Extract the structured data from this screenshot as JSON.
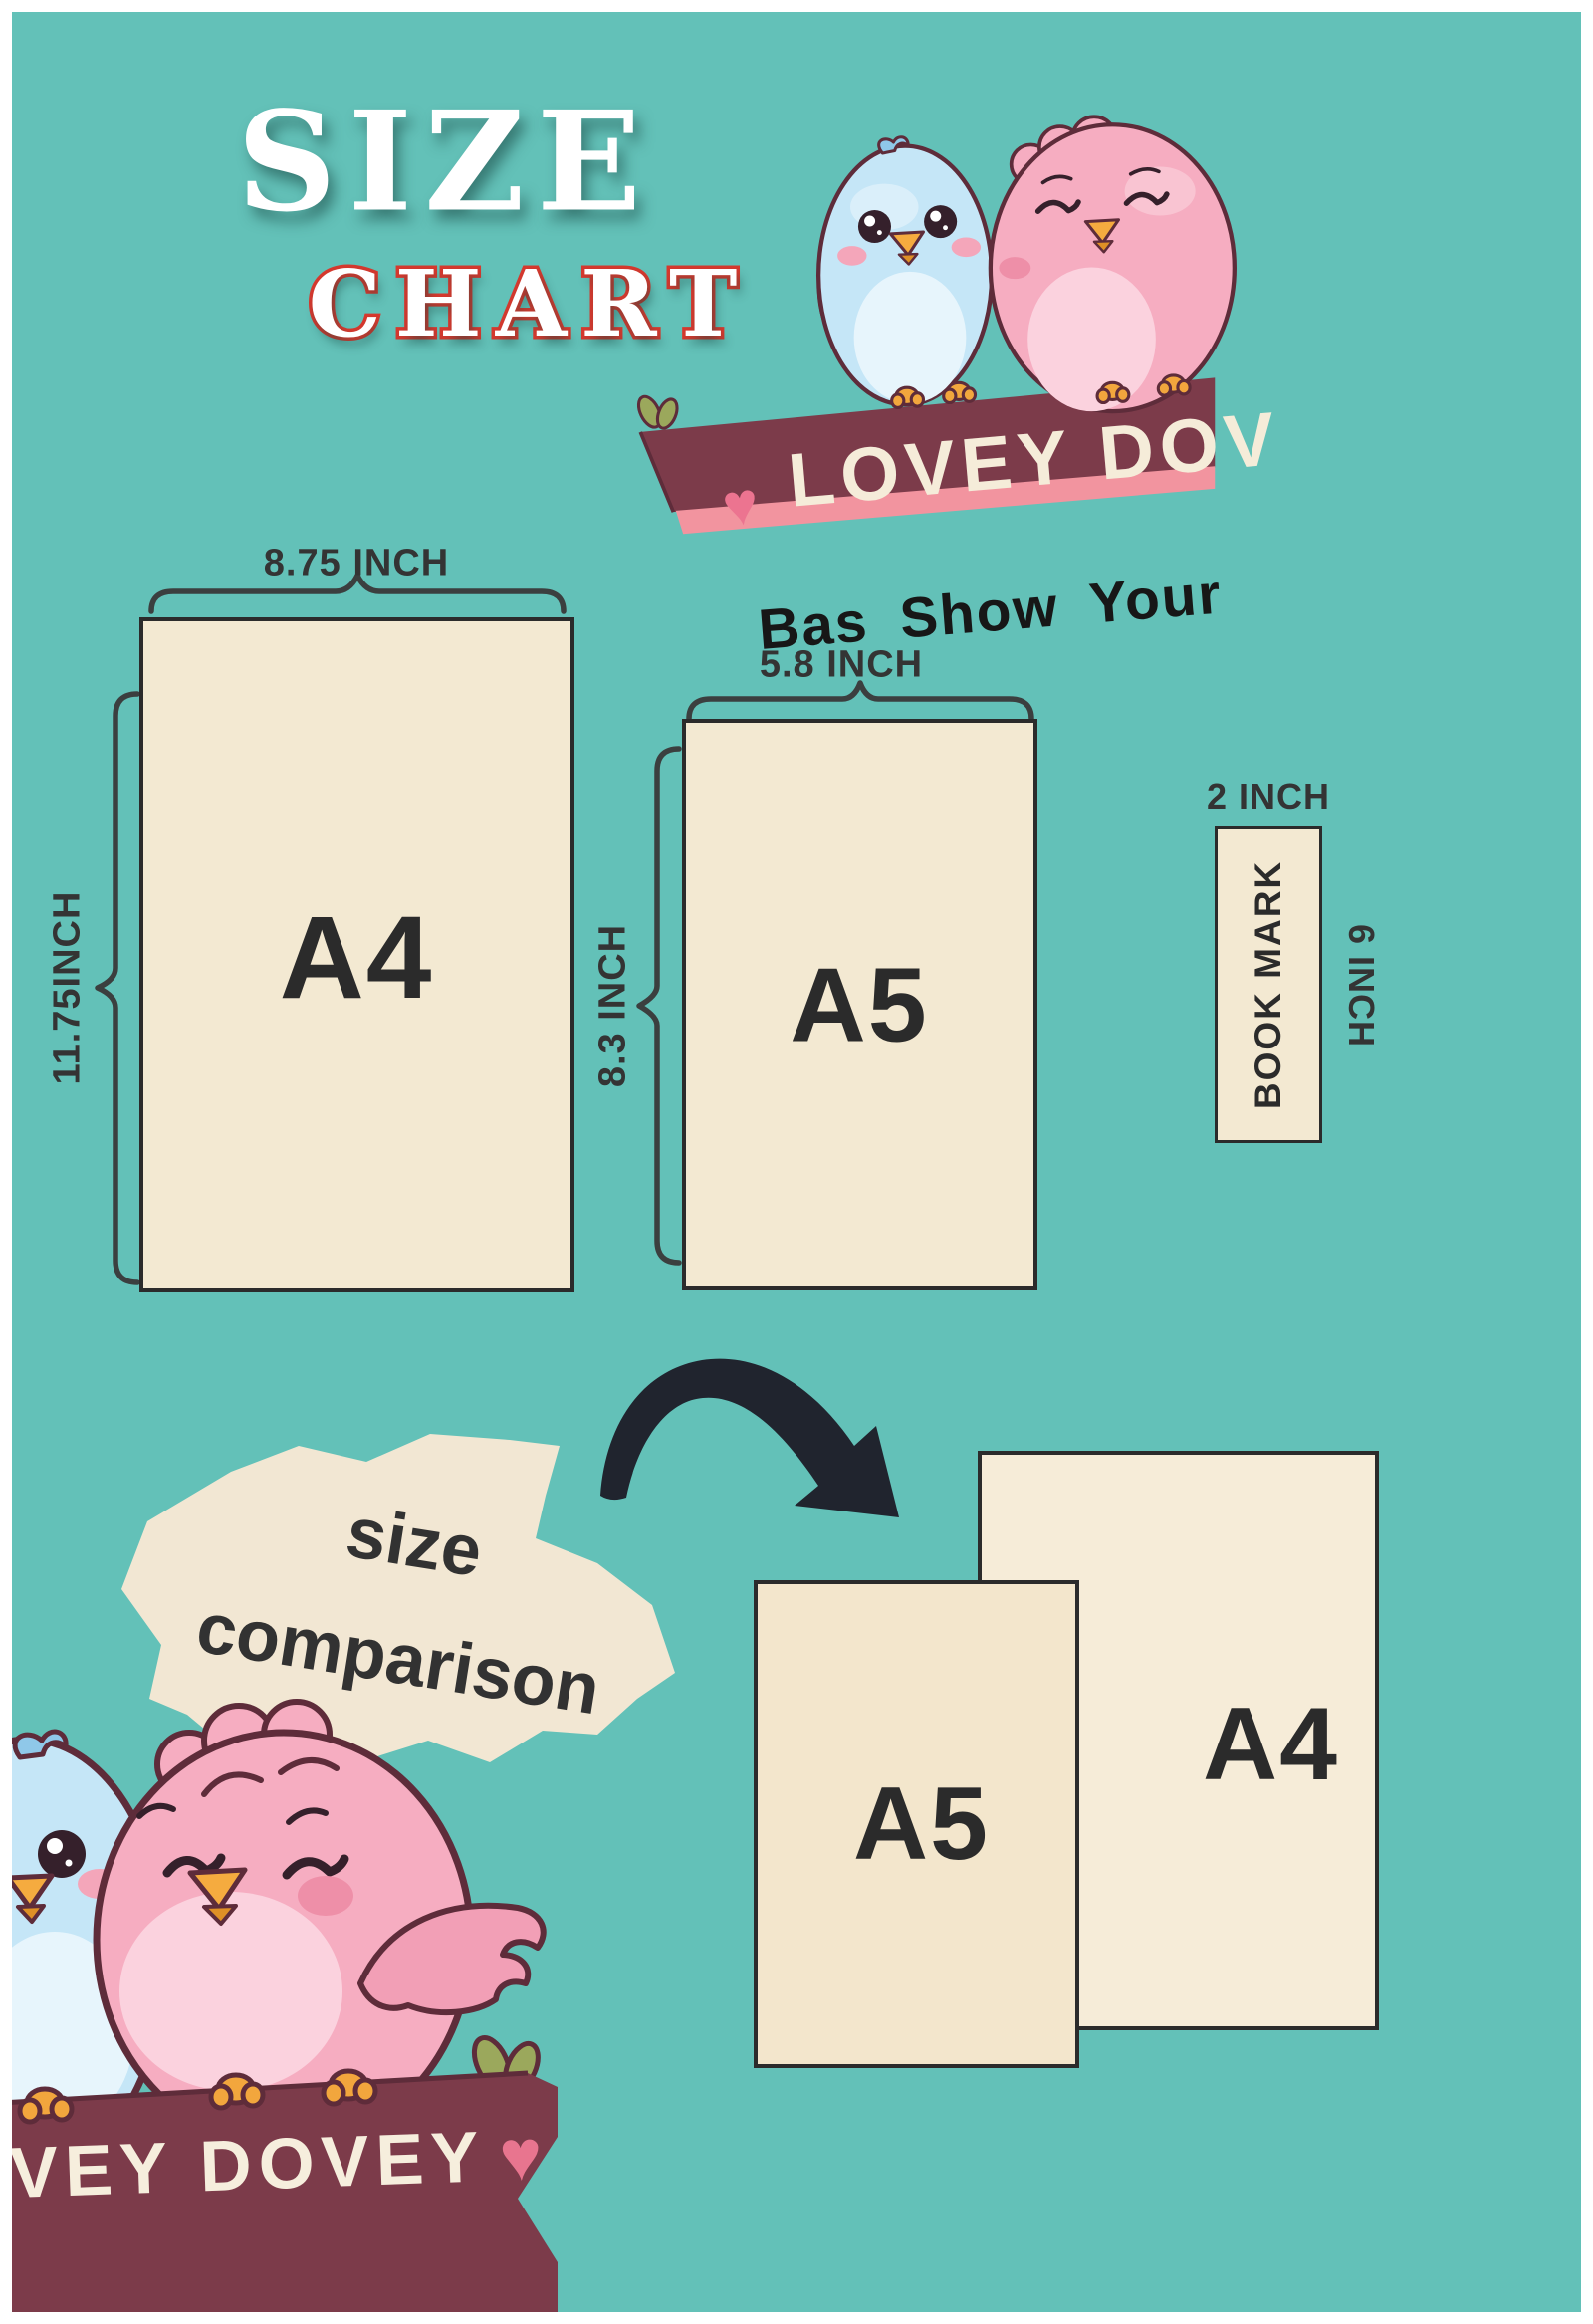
{
  "title": {
    "line1": "SIZE",
    "line2": "CHART"
  },
  "top_banner": {
    "heart": "♥",
    "text": "LOVEY DOV"
  },
  "tagline": "Bas Show Your",
  "size_chart": {
    "a4": {
      "label": "A4",
      "width_label": "8.75 INCH",
      "height_label": "11.75INCH"
    },
    "a5": {
      "label": "A5",
      "width_label": "5.8 INCH",
      "height_label": "8.3 INCH"
    },
    "bookmark": {
      "label": "BOOK MARK",
      "width_label": "2 INCH",
      "height_label": "6 INCH"
    }
  },
  "comparison": {
    "caption_line1": "size",
    "caption_line2": "comparison",
    "front_label": "A5",
    "back_label": "A4"
  },
  "bottom_banner": {
    "text": "VEY DOVEY",
    "heart": "♥"
  },
  "colors": {
    "background_teal": "#63c1b8",
    "paper_cream": "#f3e9d2",
    "banner_maroon": "#7c3b4a",
    "banner_pink_stripe": "#f2949f",
    "heart_pink": "#ec7490",
    "chart_outline_red": "#d6392e",
    "ink_dark": "#2b2b2b",
    "bird_blue": "#c5e6f7",
    "bird_pink": "#f6adc1",
    "beak_orange": "#f5ab3f",
    "leaf_olive": "#9ba85c"
  }
}
